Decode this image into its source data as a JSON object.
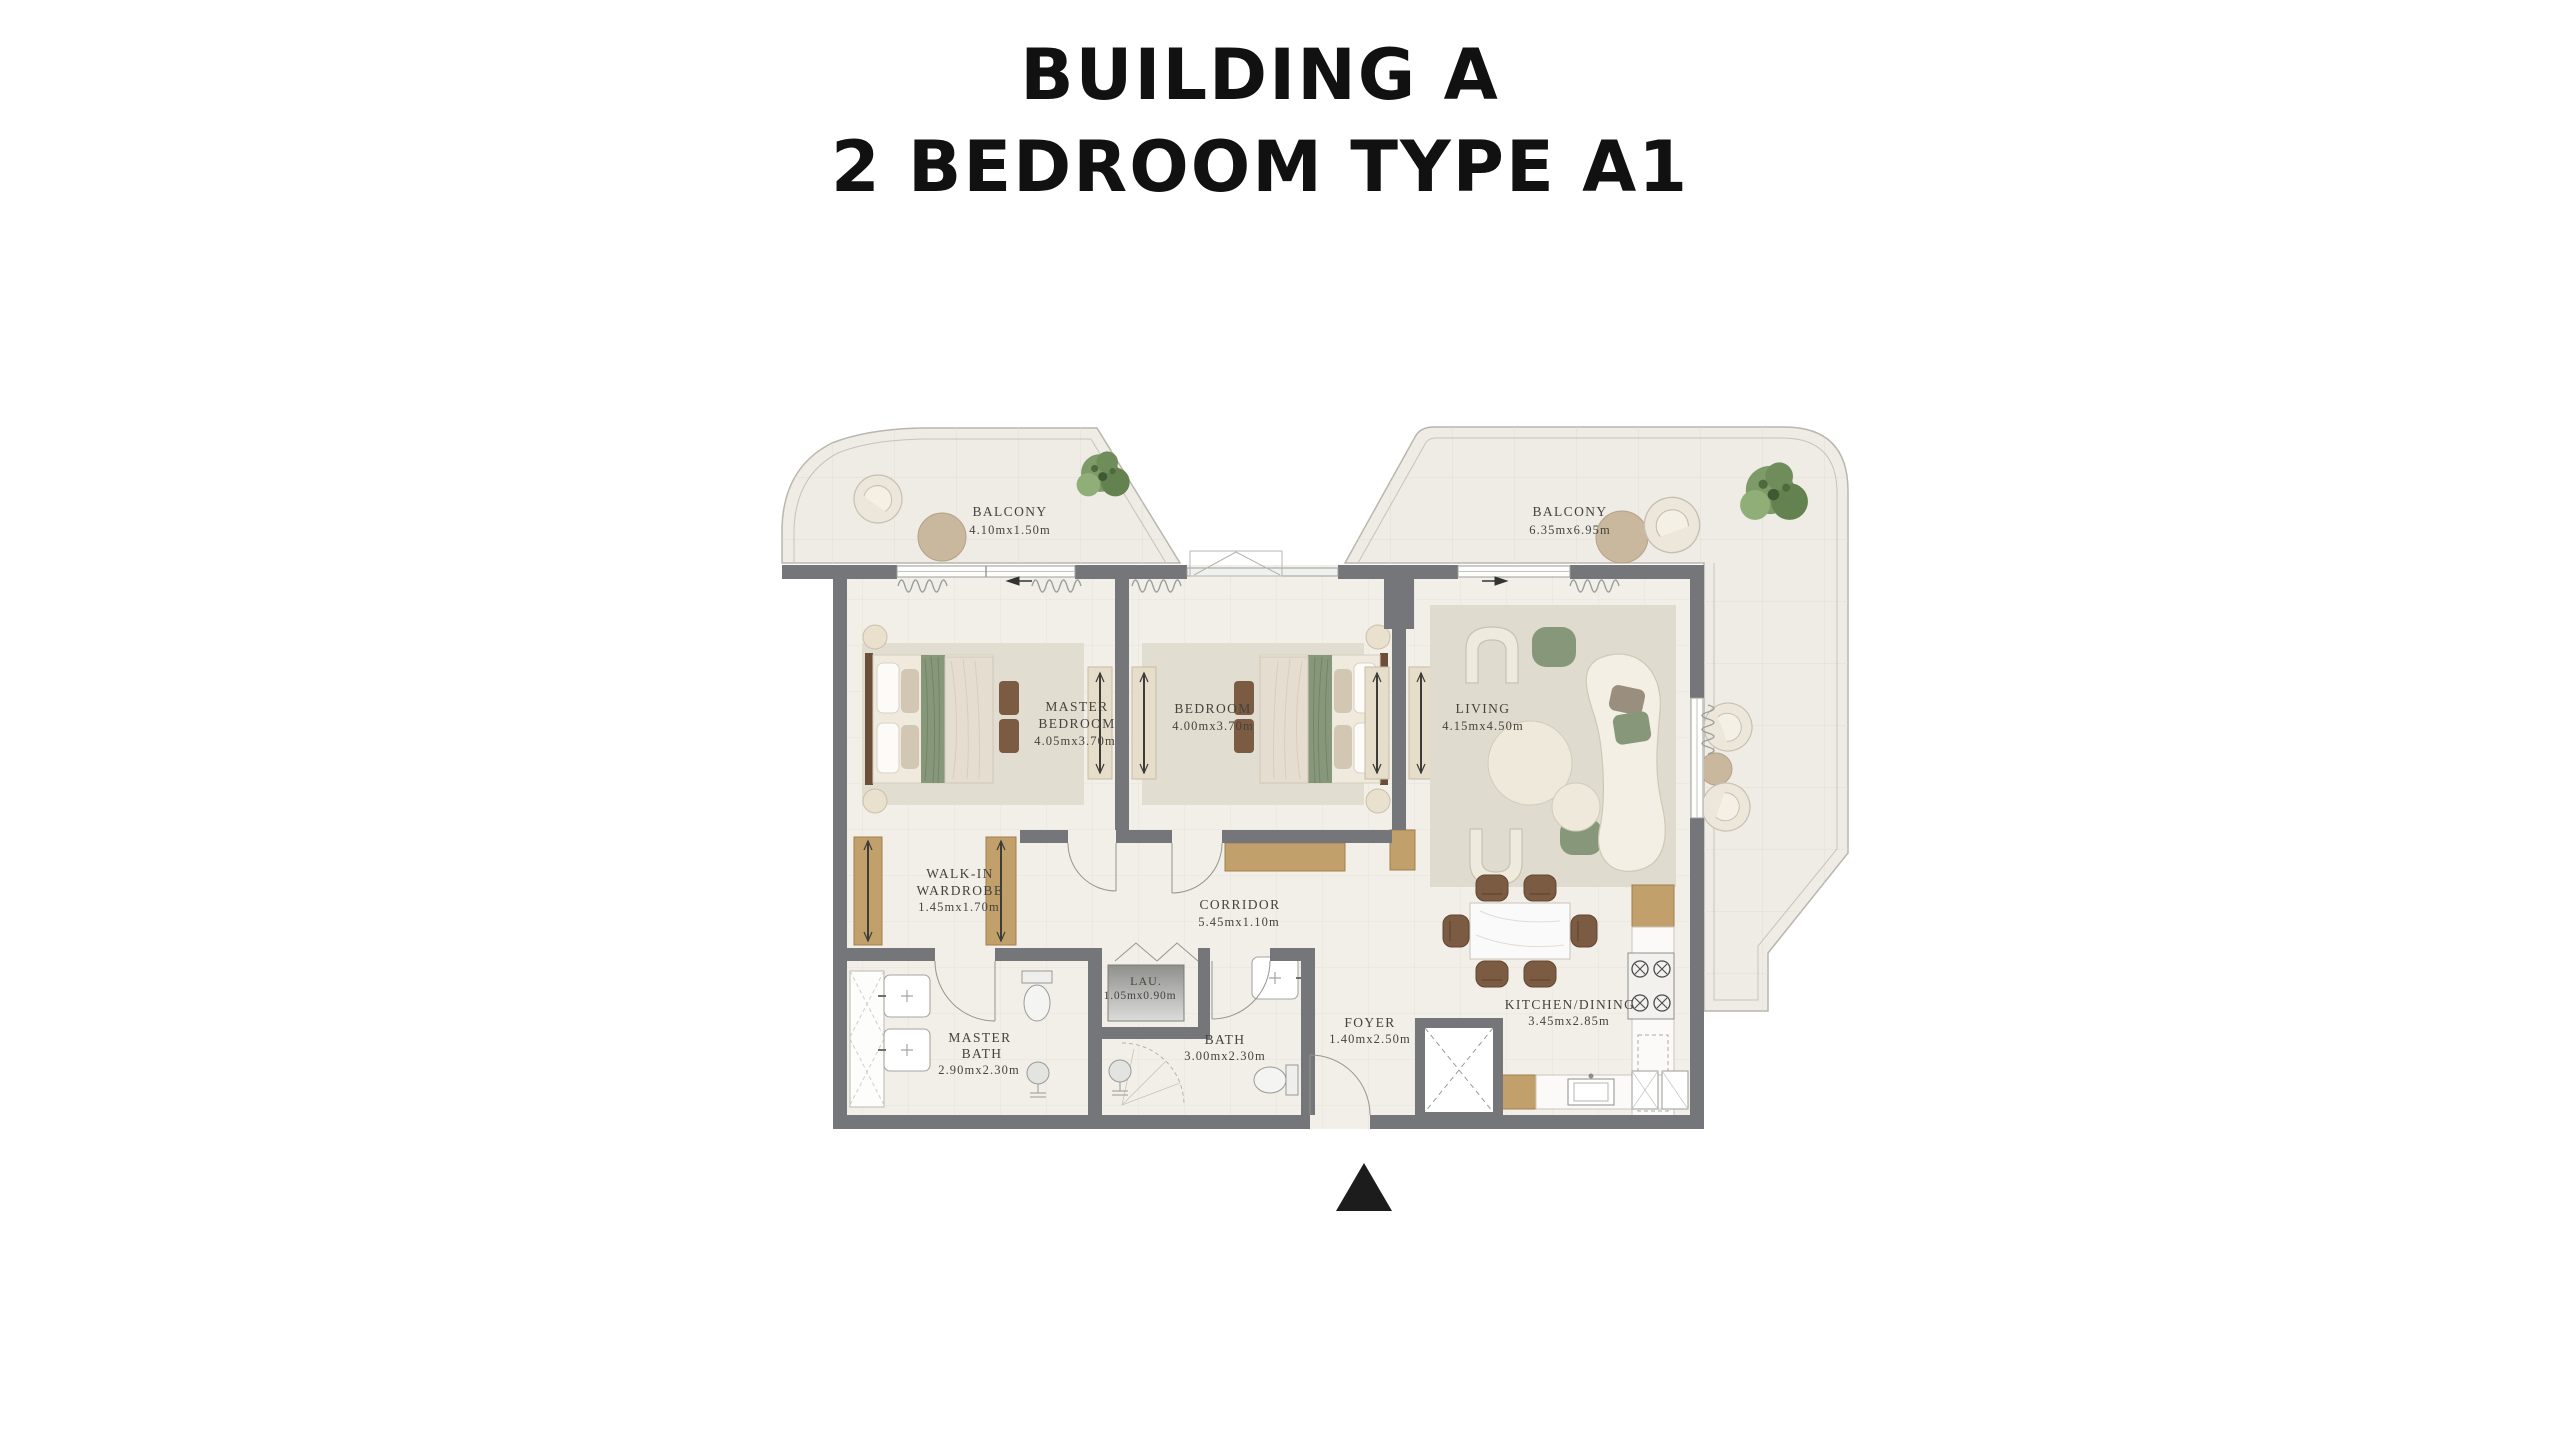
{
  "title": {
    "line1": "BUILDING A",
    "line2": "2 BEDROOM TYPE A1"
  },
  "plan": {
    "type": "apartment-floor-plan",
    "north_arrow": "up-triangle",
    "rooms": [
      {
        "id": "balcony-left",
        "name": "BALCONY",
        "dims": "4.10mx1.50m"
      },
      {
        "id": "master-bedroom",
        "name": "MASTER",
        "name2": "BEDROOM",
        "dims": "4.05mx3.70m"
      },
      {
        "id": "bedroom",
        "name": "BEDROOM",
        "dims": "4.00mx3.70m"
      },
      {
        "id": "living",
        "name": "LIVING",
        "dims": "4.15mx4.50m"
      },
      {
        "id": "balcony-right",
        "name": "BALCONY",
        "dims": "6.35mx6.95m"
      },
      {
        "id": "walk-in-wardrobe",
        "name": "WALK-IN",
        "name2": "WARDROBE",
        "dims": "1.45mx1.70m"
      },
      {
        "id": "corridor",
        "name": "CORRIDOR",
        "dims": "5.45mx1.10m"
      },
      {
        "id": "master-bath",
        "name": "MASTER",
        "name2": "BATH",
        "dims": "2.90mx2.30m"
      },
      {
        "id": "laundry",
        "name": "LAU.",
        "dims": "1.05mx0.90m"
      },
      {
        "id": "bath",
        "name": "BATH",
        "dims": "3.00mx2.30m"
      },
      {
        "id": "foyer",
        "name": "FOYER",
        "dims": "1.40mx2.50m"
      },
      {
        "id": "kitchen-dining",
        "name": "KITCHEN/DINING",
        "dims": "3.45mx2.85m"
      }
    ],
    "colors": {
      "wall": "#74767a",
      "floor": "#f2efe9",
      "balcony": "#efece6",
      "wood": "#c2a06b",
      "accent_green": "#87987a",
      "furniture_brown": "#7b5c42",
      "label": "#44433d",
      "title": "#111111",
      "north_arrow": "#1c1c1c"
    }
  }
}
